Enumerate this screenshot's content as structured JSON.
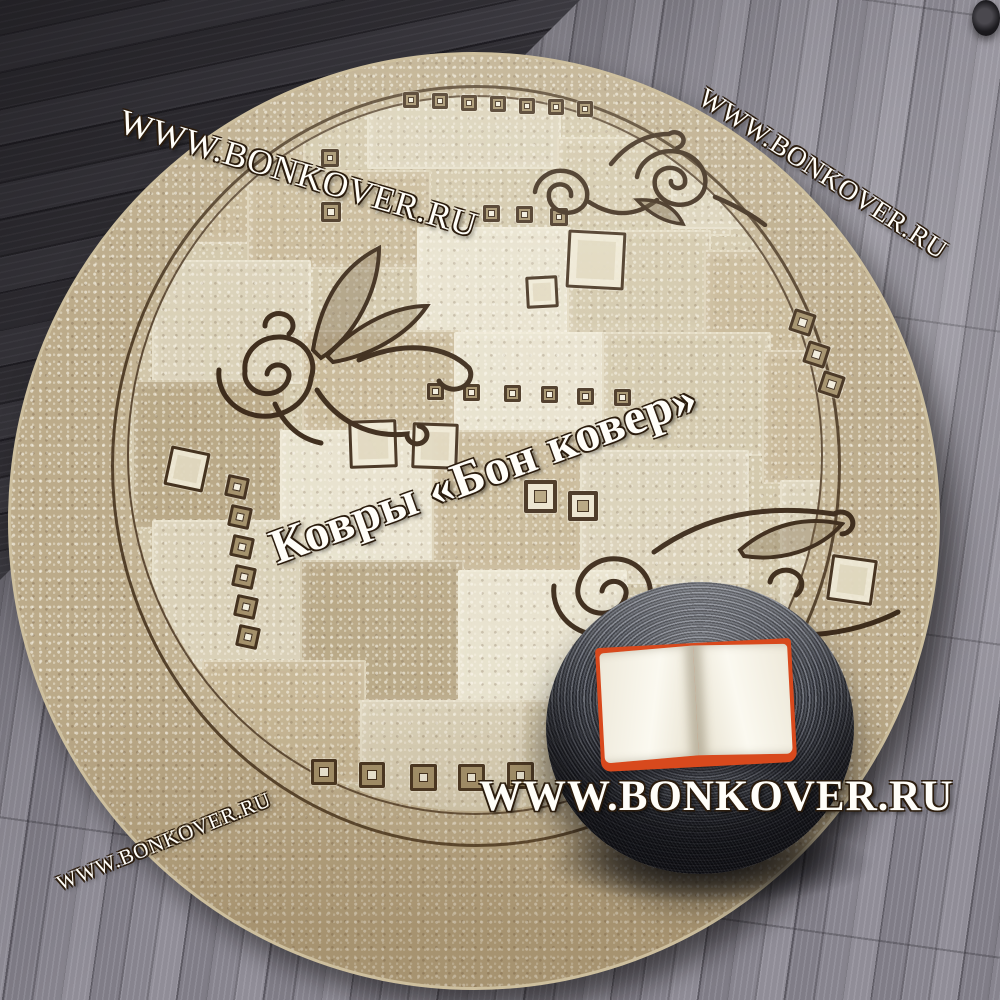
{
  "watermarks": {
    "top_left": "WWW.BONKOVER.RU",
    "top_right": "WWW.BONKOVER.RU",
    "center": "Ковры «Бон ковер»",
    "bottom_center": "WWW.BONKOVER.RU",
    "bottom_left": "WWW.BONKOVER.RU"
  },
  "palette": {
    "c1": "#c3b290",
    "c2": "#d8cfb6",
    "c3": "#e8e2ce",
    "c4": "#b2a07d",
    "c5": "#cfc3a5",
    "rug_base": "#bcab8a",
    "line_brown": "#3f2c18",
    "ornament_brown": "#3a2817",
    "floor_gray": "#7d7a83",
    "floor_dark": "#2b292f",
    "pouf_dark": "#33353c",
    "pouf_light": "#777b85",
    "book_cover_orange": "#d8491d",
    "book_pages": "#f6f2e6",
    "watermark_white": "#fffef9"
  },
  "decor": {
    "squares": [
      [
        392,
        37,
        16,
        "f",
        0
      ],
      [
        421,
        38,
        16,
        "f",
        0
      ],
      [
        450,
        40,
        16,
        "f",
        0
      ],
      [
        479,
        41,
        16,
        "f",
        0
      ],
      [
        508,
        43,
        16,
        "f",
        0
      ],
      [
        537,
        44,
        16,
        "f",
        0
      ],
      [
        566,
        46,
        16,
        "f",
        0
      ],
      [
        310,
        94,
        18,
        "f",
        0
      ],
      [
        310,
        147,
        20,
        "f",
        0
      ],
      [
        472,
        150,
        17,
        "f",
        0
      ],
      [
        505,
        151,
        17,
        "f",
        0
      ],
      [
        539,
        153,
        18,
        "f",
        0
      ],
      [
        416,
        328,
        17,
        "f",
        0
      ],
      [
        452,
        329,
        17,
        "f",
        0
      ],
      [
        493,
        330,
        17,
        "f",
        0
      ],
      [
        530,
        331,
        17,
        "f",
        0
      ],
      [
        566,
        333,
        17,
        "f",
        0
      ],
      [
        603,
        334,
        17,
        "f",
        0
      ],
      [
        513,
        425,
        33,
        "fb",
        0
      ],
      [
        557,
        436,
        30,
        "fb",
        0
      ],
      [
        338,
        365,
        48,
        "o",
        -2
      ],
      [
        401,
        368,
        46,
        "o",
        2
      ],
      [
        556,
        176,
        58,
        "o",
        3
      ],
      [
        515,
        221,
        32,
        "o",
        -3
      ],
      [
        818,
        502,
        46,
        "o",
        8
      ],
      [
        780,
        256,
        23,
        "f",
        18
      ],
      [
        794,
        288,
        23,
        "f",
        18
      ],
      [
        809,
        318,
        23,
        "f",
        18
      ],
      [
        156,
        394,
        40,
        "o",
        12
      ],
      [
        215,
        421,
        22,
        "f",
        12
      ],
      [
        218,
        451,
        22,
        "f",
        12
      ],
      [
        220,
        481,
        22,
        "f",
        12
      ],
      [
        222,
        511,
        22,
        "f",
        12
      ],
      [
        224,
        541,
        22,
        "f",
        12
      ],
      [
        226,
        571,
        22,
        "f",
        12
      ],
      [
        300,
        704,
        26,
        "f",
        0
      ],
      [
        348,
        707,
        26,
        "f",
        0
      ],
      [
        399,
        709,
        27,
        "f",
        0
      ],
      [
        447,
        709,
        27,
        "f",
        0
      ],
      [
        496,
        707,
        27,
        "f",
        0
      ]
    ],
    "patches": [
      [
        356,
        40,
        190,
        70,
        "c2"
      ],
      [
        546,
        82,
        170,
        95,
        "c5"
      ],
      [
        150,
        75,
        140,
        110,
        "c1"
      ],
      [
        660,
        90,
        120,
        80,
        "c2"
      ],
      [
        236,
        115,
        180,
        95,
        "c1"
      ],
      [
        406,
        172,
        150,
        105,
        "c3"
      ],
      [
        556,
        175,
        140,
        100,
        "c5"
      ],
      [
        693,
        195,
        135,
        105,
        "c1"
      ],
      [
        141,
        205,
        155,
        120,
        "c2"
      ],
      [
        291,
        275,
        155,
        100,
        "c1"
      ],
      [
        443,
        277,
        150,
        100,
        "c3"
      ],
      [
        591,
        277,
        165,
        120,
        "c5"
      ],
      [
        121,
        325,
        150,
        145,
        "c4"
      ],
      [
        269,
        375,
        155,
        130,
        "c3"
      ],
      [
        421,
        375,
        150,
        140,
        "c1"
      ],
      [
        569,
        395,
        165,
        130,
        "c2"
      ],
      [
        751,
        295,
        115,
        130,
        "c1"
      ],
      [
        141,
        465,
        150,
        145,
        "c2"
      ],
      [
        289,
        505,
        160,
        140,
        "c4"
      ],
      [
        447,
        515,
        165,
        130,
        "c3"
      ],
      [
        610,
        540,
        150,
        120,
        "c1"
      ],
      [
        769,
        425,
        105,
        140,
        "c2"
      ],
      [
        191,
        605,
        160,
        120,
        "c1"
      ],
      [
        349,
        645,
        160,
        120,
        "c2"
      ],
      [
        509,
        645,
        130,
        120,
        "c5"
      ]
    ]
  }
}
